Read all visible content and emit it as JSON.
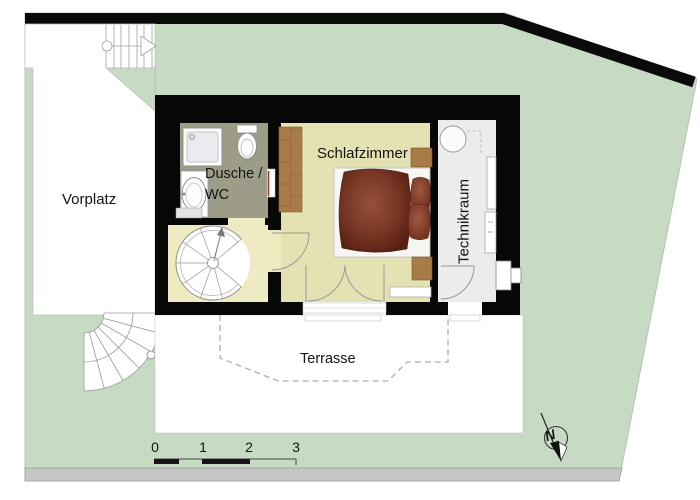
{
  "floor_plan": {
    "rooms": {
      "vorplatz": {
        "label": "Vorplatz"
      },
      "bathroom": {
        "label_line1": "Dusche /",
        "label_line2": "WC"
      },
      "bedroom": {
        "label": "Schlafzimmer"
      },
      "technical_room": {
        "label": "Technikraum"
      },
      "terrace": {
        "label": "Terrasse"
      }
    },
    "scale_bar": {
      "unit_labels": [
        "0",
        "1",
        "2",
        "3"
      ]
    },
    "compass": {
      "north_label": "N"
    },
    "colors": {
      "site_green": "#C7DAC4",
      "wall_black": "#070707",
      "bathroom_floor": "#9C9C87",
      "stair_hall_floor": "#EEEBC3",
      "bedroom_floor": "#E4E2B2",
      "technical_floor": "#ECECEC",
      "wood_brown": "#A87C46",
      "duvet_maroon": "#6B2E1E",
      "road_gray": "#C6C6C6"
    }
  }
}
